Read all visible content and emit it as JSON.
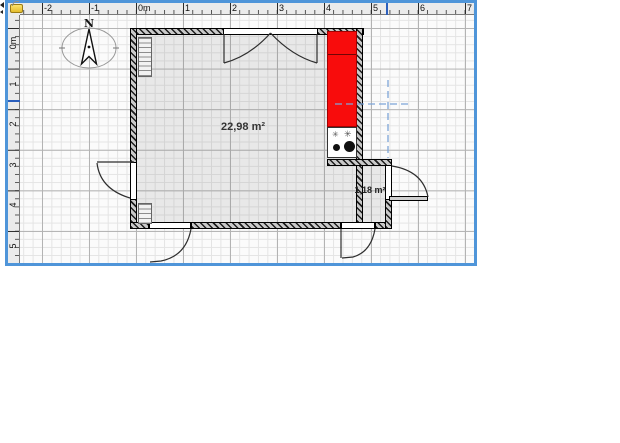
{
  "rulers": {
    "horizontal": [
      "-2",
      "-1",
      "0m",
      "1",
      "2",
      "3",
      "4",
      "5",
      "6",
      "7"
    ],
    "vertical": [
      "0m",
      "1",
      "2",
      "3",
      "4",
      "5"
    ]
  },
  "compass": {
    "label": "N"
  },
  "rooms": {
    "main": {
      "area": "22,98 m²"
    },
    "small": {
      "area": "1,18 m²"
    }
  },
  "colors": {
    "furniture_red": "#f80c0c",
    "focus_border_blue": "#4f95d9",
    "guide_line_blue": "#7da5d8",
    "ruler_marker_blue": "#2b5fbc"
  }
}
